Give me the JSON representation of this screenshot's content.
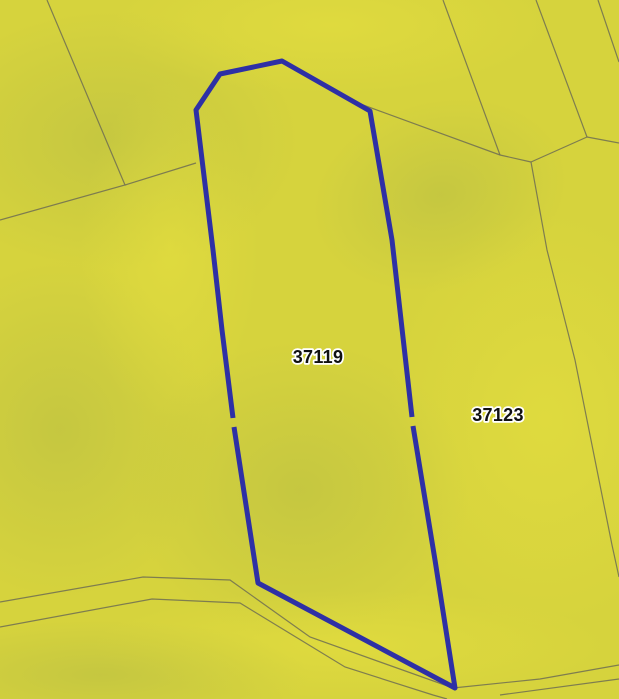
{
  "map": {
    "description": "cadastral parcel map with one highlighted parcel",
    "parcels": [
      {
        "id": "37119",
        "highlighted": true
      },
      {
        "id": "37123",
        "highlighted": false
      }
    ],
    "colors": {
      "background": "#d6d33d",
      "highlight_outline": "#2e30a5",
      "boundary_line": "#6e6d52",
      "label_text": "#111111",
      "label_halo": "#ffffff"
    }
  }
}
